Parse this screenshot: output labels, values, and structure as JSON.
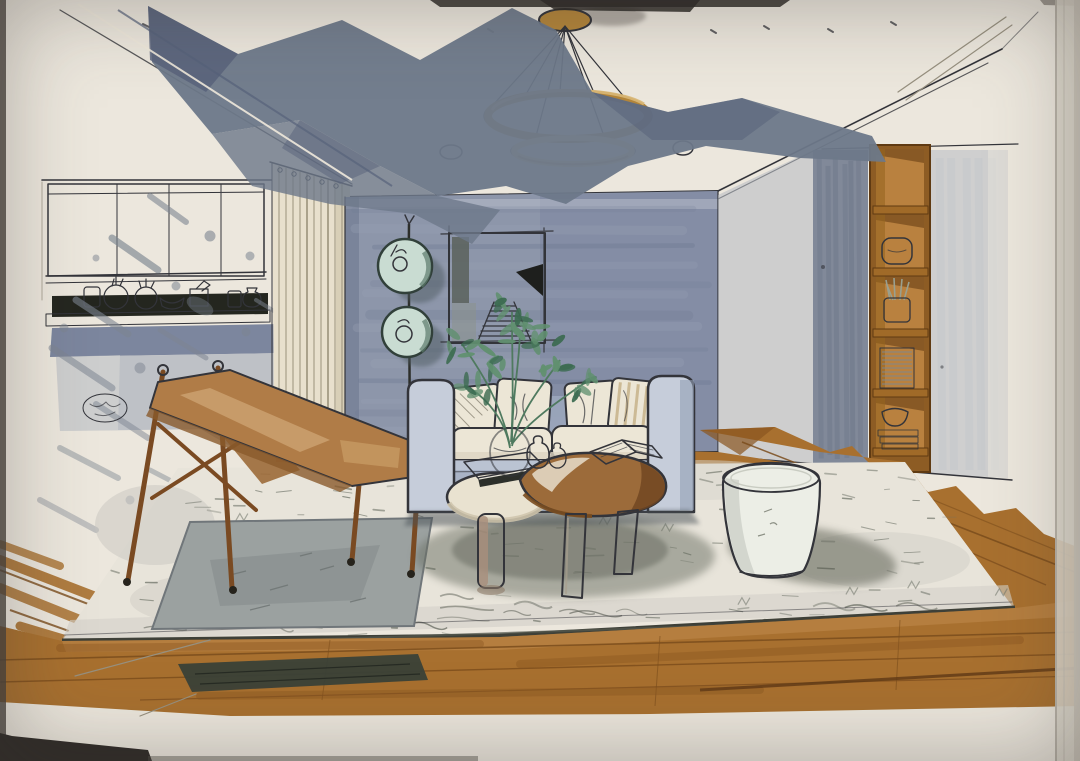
{
  "artwork": {
    "type": "hand-drawn interior design marker rendering, photographed on paper",
    "subject": "modern living room in one-point perspective: kitchen pass-through with ceramics, cream curtain, blue-grey feature wall with two round teal wall discs and abstract framed art, light-blue sofa with cream pillows, potted green plant, nesting coffee tables with books, wooden sling chair on grey mat, white drum stool, built-in wooden cubby shelving, gold double-ring chandelier, wood floor and large light rug",
    "visible_text": "none"
  },
  "palette": {
    "paper": "#ece7dd",
    "paper_edge": "#ddd7cb",
    "photo_background": "#3a3531",
    "ink": "#33343a",
    "pencil": "#97907f",
    "beam_slate": "#6d7889",
    "beam_slate_deep": "#57627a",
    "wall_blue": "#8d96aa",
    "wall_blue_dark": "#76819a",
    "wall_wash_light": "#b2b7c1",
    "curtain_cream": "#e8e0cd",
    "curtain_line": "#9a927b",
    "shelf_wood": "#8d5c24",
    "shelf_wood_light": "#b9813f",
    "shelf_wood_dark": "#7c4f1f",
    "floor_wood": "#a8702f",
    "floor_wood_dark": "#7a4c1c",
    "floor_wood_light": "#c08a4d",
    "olive_streak": "#3a4138",
    "rug": "#e8e4da",
    "rug_scribble": "#6d7267",
    "mat_gray": "#9ba1a0",
    "sofa_blue": "#a9b3c6",
    "sofa_blue_light": "#c6cdda",
    "cushion_cream": "#ece6d6",
    "pillow_stripe": "#c7b28a",
    "plant_green": "#619070",
    "plant_green_dark": "#3c6b51",
    "disc_teal": "#c9dcd2",
    "disc_rim": "#31403a",
    "gold": "#b3853a",
    "gold_pale": "#e3d3a0",
    "chair_wood": "#7a4a22",
    "chair_sling": "#b07c47",
    "chair_sling_light": "#d2a878",
    "stool_white": "#eceee6",
    "stool_shade": "#cdd0c8",
    "table_cream": "#e9e2d0",
    "table_wood": "#9c6b3a",
    "shadow": "#5d6157",
    "black_band": "#24261f"
  },
  "objects": [
    {
      "name": "ring-chandelier",
      "description": "two gold suspended rings on thin cables from a gold ceiling canopy"
    },
    {
      "name": "ceiling-downlights",
      "description": "two small sketched recessed lights"
    },
    {
      "name": "beam-shadow",
      "description": "large dark slate marker sweep across upper-left ceiling"
    },
    {
      "name": "kitchen-pass-through",
      "description": "white upper cabinets, open shelf with white ceramics over a black band, blue-grey lower counter"
    },
    {
      "name": "curtain",
      "description": "cream pleated floor curtain"
    },
    {
      "name": "feature-wall",
      "description": "blue-grey back wall"
    },
    {
      "name": "wall-discs",
      "description": "two round teal discs mounted on a vertical black pole"
    },
    {
      "name": "framed-artwork",
      "description": "abstract print with dark strip, black wedge and stair motif"
    },
    {
      "name": "sofa",
      "description": "light blue-grey two-seat sofa with cream seat and back pillows"
    },
    {
      "name": "plant",
      "description": "green leafy branches in a round glass vase with two small white bud vases"
    },
    {
      "name": "nesting-tables",
      "description": "cream round table with dark book and kidney-shaped wood table with open book"
    },
    {
      "name": "sling-chair",
      "description": "wooden frame lounge chair with tan leather sling"
    },
    {
      "name": "floor-mat",
      "description": "grey rectangular mat under the chair"
    },
    {
      "name": "area-rug",
      "description": "large light rug with scribbled texture and dark edge"
    },
    {
      "name": "drum-stool",
      "description": "white barrel-shaped stool"
    },
    {
      "name": "built-in-shelving",
      "description": "tall wooden cubby bookcase with pillow, pot plant, striped books and bowl"
    },
    {
      "name": "wood-floor",
      "description": "warm brown plank floor in foreground and right sweep"
    },
    {
      "name": "photo-paper",
      "description": "cream drawing paper with dark photo background at the edges"
    }
  ]
}
